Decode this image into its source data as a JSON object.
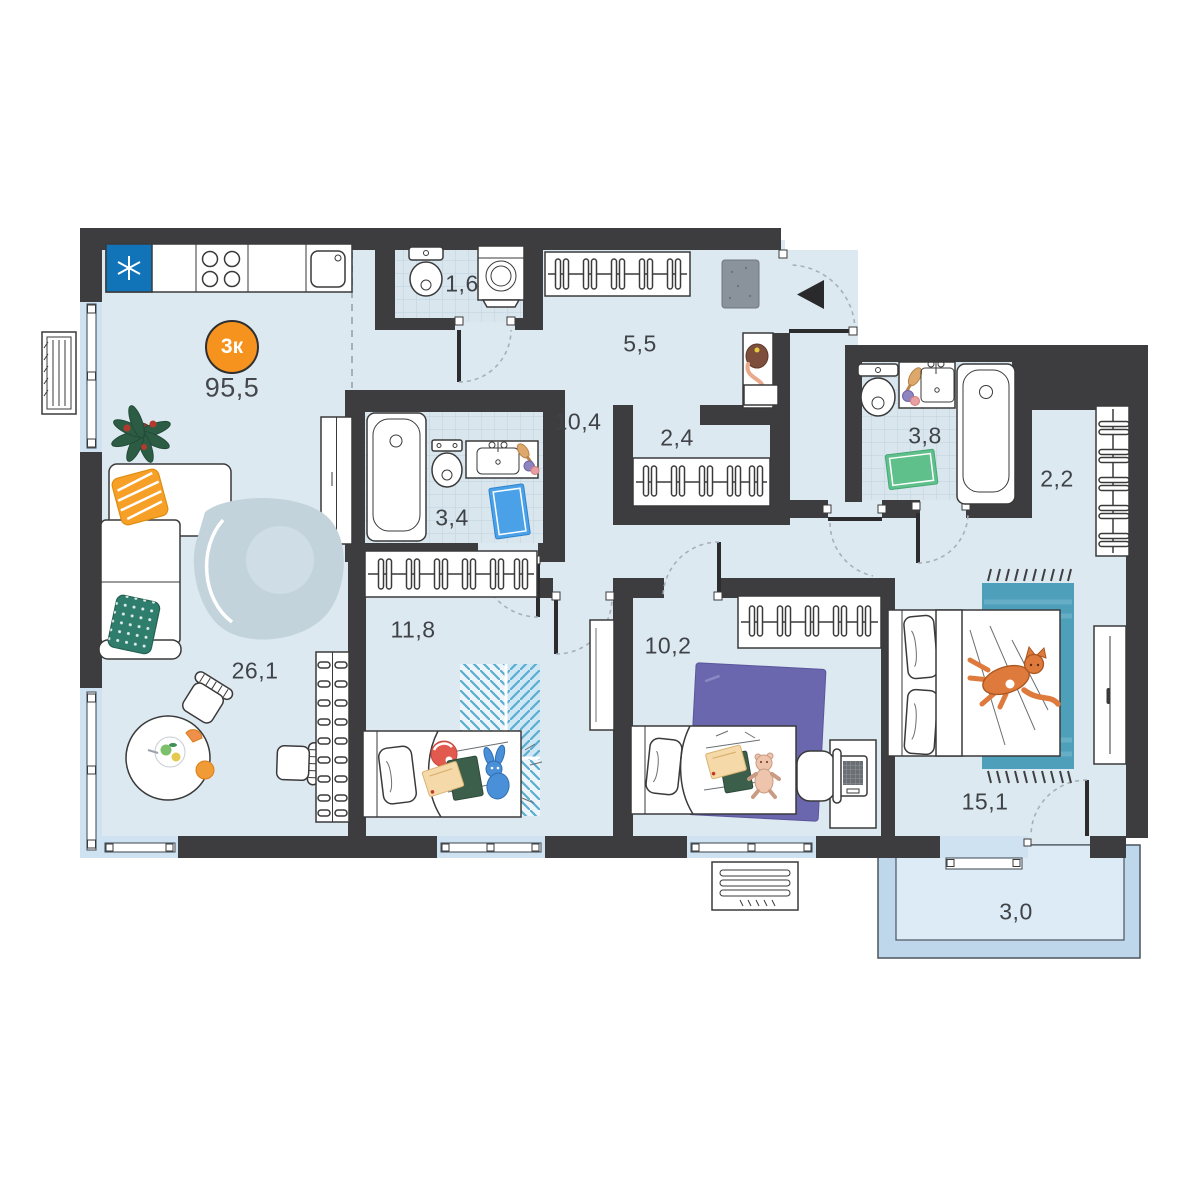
{
  "badge": {
    "label": "3к"
  },
  "total_area": "95,5",
  "rooms": {
    "kitchen_living": {
      "area": "26,1"
    },
    "corridor": {
      "area": "10,4"
    },
    "hallway": {
      "area": "5,5"
    },
    "wc": {
      "area": "1,6"
    },
    "storage": {
      "area": "2,4"
    },
    "bathroom": {
      "area": "3,4"
    },
    "master_bathroom": {
      "area": "3,8"
    },
    "wardrobe": {
      "area": "2,2"
    },
    "kids_room": {
      "area": "11,8"
    },
    "kids_room_2": {
      "area": "10,2"
    },
    "bedroom": {
      "area": "15,1"
    },
    "balcony": {
      "area": "3,0"
    }
  },
  "colors": {
    "wall": "#3d3d3f",
    "floor": "#dde9f1",
    "floor_tile": "#d9e6ee",
    "window_band": "#cfe2f2",
    "balcony_frame": "#bfd7eb",
    "balcony_floor": "#dcebf5",
    "dash": "#a7b0b8",
    "accent": "#f6921e",
    "fridge": "#1173b8",
    "pillow_orange": "#f7a028",
    "pillow_teal": "#2f7d6d",
    "rug_living": "#c3d3dc",
    "rug_kids_stripe": "#59aecf",
    "rug_purple": "#6b67ae",
    "rug_teal": "#4e9fba",
    "rug_green": "#5fc08c",
    "rug_bath_blue": "#4aa1e8",
    "cat": "#dd7a3c"
  }
}
